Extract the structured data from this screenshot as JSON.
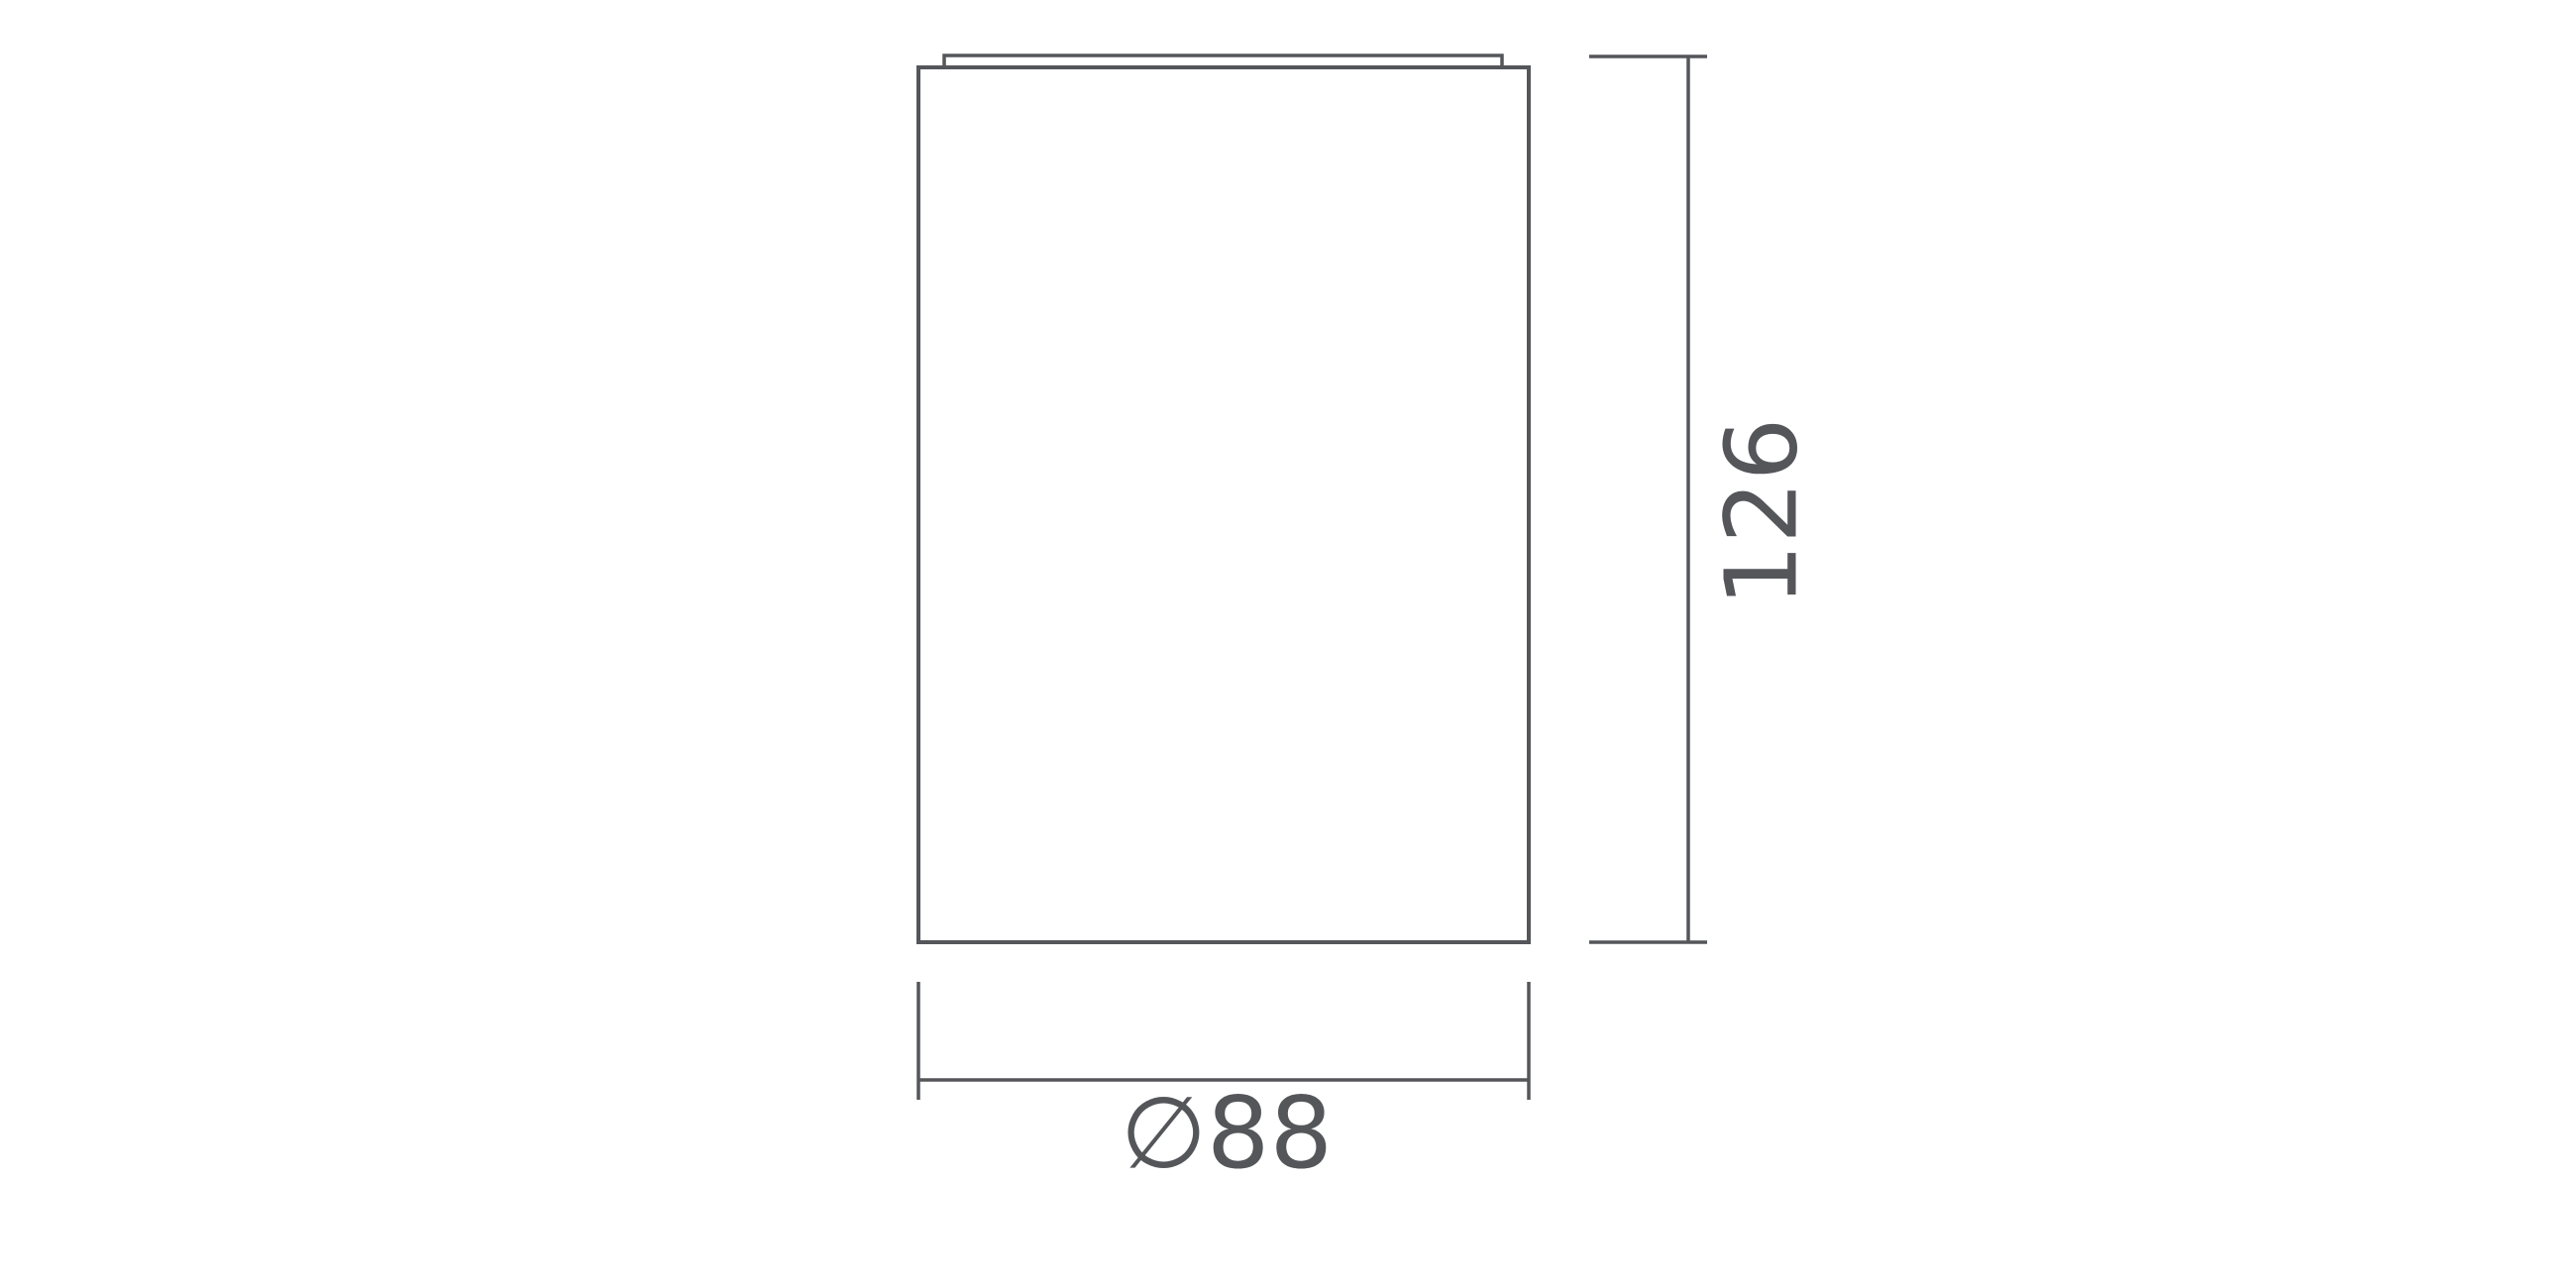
{
  "drawing": {
    "title": "cylindrical-fixture-dimension-drawing",
    "line_color": "#54565a",
    "text_color": "#54565a",
    "height_dimension": {
      "value": "126",
      "orientation": "vertical"
    },
    "diameter_dimension": {
      "value": "∅88",
      "orientation": "horizontal"
    }
  }
}
